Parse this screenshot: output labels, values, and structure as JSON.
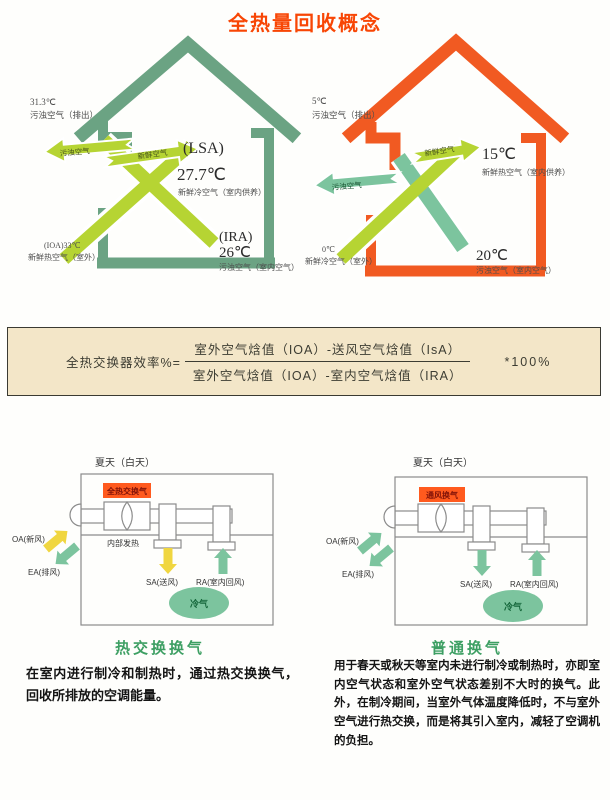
{
  "title": "全热量回收概念",
  "colors": {
    "title": "#f84605",
    "house_summer_green": "#6ba383",
    "house_winter_orange": "#f15a22",
    "arrow_lime": "#b6d433",
    "arrow_green": "#7cc49e",
    "arrow_yellow": "#f0d640",
    "formula_bg": "#f3e6c8",
    "caption_green": "#3d9f63",
    "unit_label_bg": "#ff5a1e"
  },
  "summer_house": {
    "exhaust_temp": "31.3℃",
    "exhaust_label": "污浊空气（排出）",
    "stale_arrow_label": "污浊空气",
    "fresh_arrow_label": "新鲜空气",
    "supply_code": "(LSA)",
    "supply_temp": "27.7℃",
    "supply_label": "新鲜冷空气（室内供养）",
    "return_code": "(IRA)",
    "return_temp": "26℃",
    "return_label": "污浊空气（室内空气）",
    "outdoor_temp": "(IOA)33℃",
    "outdoor_label": "新鲜热空气（室外）"
  },
  "winter_house": {
    "exhaust_temp": "5℃",
    "exhaust_label": "污浊空气（排出）",
    "stale_arrow_label": "污浊空气",
    "fresh_arrow_label": "新鲜空气",
    "supply_temp": "15℃",
    "supply_label": "新鲜热空气（室内供养）",
    "return_temp": "20℃",
    "return_label": "污浊空气（室内空气）",
    "outdoor_temp": "0℃",
    "outdoor_label": "新鲜冷空气（室外）"
  },
  "formula": {
    "label": "全热交换器效率%=",
    "numerator": "室外空气焓值（IOA）-送风空气焓值（IsA）",
    "denominator": "室外空气焓值（IOA）-室内空气焓值（IRA）",
    "multiplier": "*100%"
  },
  "exchange_diagram": {
    "season": "夏天（白天）",
    "unit_label": "全热交换气",
    "internal_heat": "内部发热",
    "oa_label": "OA(新风)",
    "ea_label": "EA(排风)",
    "sa_label": "SA(送风)",
    "ra_label": "RA(室内回风)",
    "cool_label": "冷气",
    "caption": "热交换换气",
    "description": "在室内进行制冷和制热时，通过热交换换气，回收所排放的空调能量。"
  },
  "normal_diagram": {
    "season": "夏天（白天）",
    "unit_label": "通风换气",
    "oa_label": "OA(新风)",
    "ea_label": "EA(排风)",
    "sa_label": "SA(送风)",
    "ra_label": "RA(室内回风)",
    "cool_label": "冷气",
    "caption": "普通换气",
    "description": "用于春天或秋天等室内未进行制冷或制热时，亦即室内空气状态和室外空气状态差别不大时的换气。此外，在制冷期间，当室外气体温度降低时，不与室外空气进行热交换，而是将其引入室内，减轻了空调机的负担。"
  }
}
